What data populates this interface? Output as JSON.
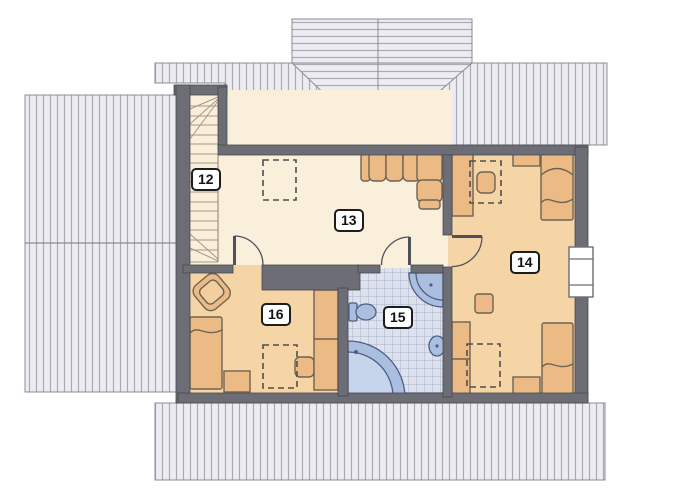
{
  "rooms": [
    {
      "label": "12"
    },
    {
      "label": "13"
    },
    {
      "label": "14"
    },
    {
      "label": "15"
    },
    {
      "label": "16"
    }
  ],
  "palette": {
    "roof_fill": "#ececf2",
    "roof_stripe": "#aaaab5",
    "roof_border": "#8b8b96",
    "wall": "#6d6d76",
    "wall_edge": "#47474f",
    "floor_cream": "#f9efdb",
    "floor_tan": "#f5d5a6",
    "furniture": "#ecbb85",
    "furniture_edge": "#6e6353",
    "stair_line": "#a59b83",
    "dash_line": "#4f4f4f",
    "tile_bg": "#dde2ee",
    "tile_line": "#a9b2cb",
    "fixture": "#aabedf",
    "fixture_edge": "#4f5d85",
    "fixture_inner": "#c6d4ec",
    "label_border": "#1d1d1d"
  }
}
